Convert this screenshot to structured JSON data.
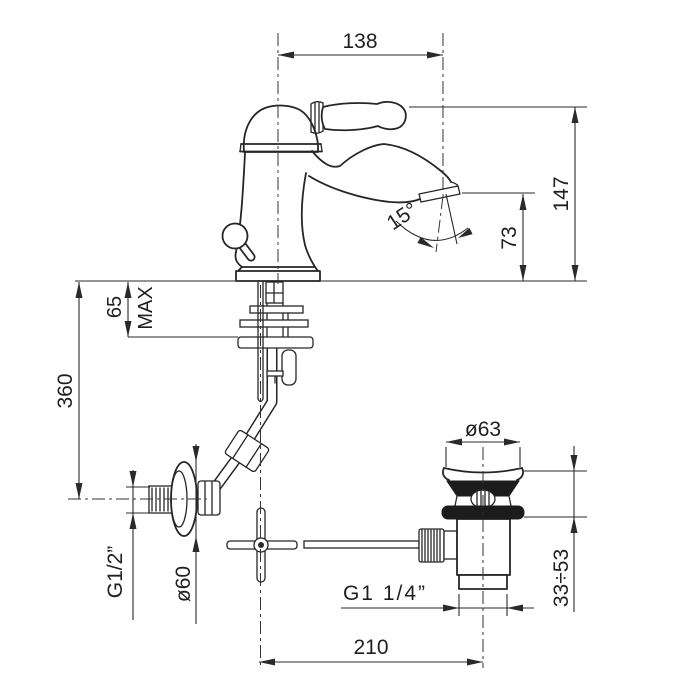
{
  "dims": {
    "spout_reach": "138",
    "overall_height": "147",
    "outlet_height": "73",
    "outlet_angle": "15°",
    "max_deck": "65",
    "max_deck_suffix": "MAX",
    "wall_supply_drop": "360",
    "supply_thread": "G1/2”",
    "escutcheon_diameter": "ø60",
    "waste_flange_diameter": "ø63",
    "waste_thread": "G1 1/4”",
    "clamping_range": "33÷53",
    "drain_offset": "210"
  },
  "colors": {
    "line": "#262626",
    "section_fill": "#1c1c1c",
    "background": "#ffffff"
  }
}
